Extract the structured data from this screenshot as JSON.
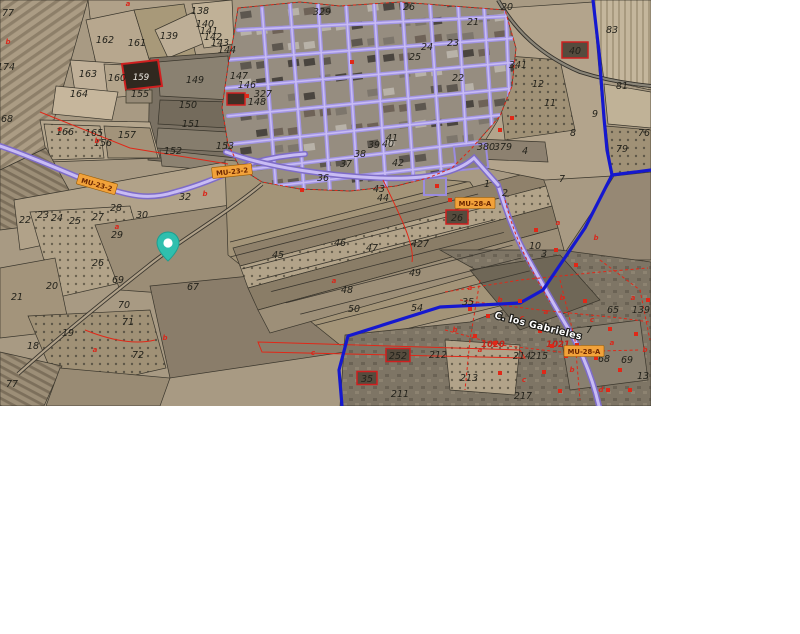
{
  "map": {
    "street_name": "C. los Gabrieles",
    "colors": {
      "pin": "#2fbfae",
      "boundary_line": "#1518cf",
      "road_purple": "#a295e4",
      "road_purple_core": "#c8bcf4",
      "road_label_bg": "#f2a23a",
      "road_label_text": "#6b2600",
      "red_overlay": "#e02818",
      "highlight_parcel_border": "#cf1f1f"
    },
    "pin": {
      "x": 168,
      "y": 247
    },
    "highlight_parcel": {
      "t": "159",
      "x": 141,
      "y": 80
    },
    "road_labels": [
      {
        "text": "MU-23-2",
        "x": 97,
        "y": 184,
        "rot": 16
      },
      {
        "text": "MU-23-2",
        "x": 232,
        "y": 171,
        "rot": -6
      },
      {
        "text": "MU-28-A",
        "x": 475,
        "y": 203,
        "rot": 0
      },
      {
        "text": "MU-28-A",
        "x": 584,
        "y": 351,
        "rot": 0
      }
    ],
    "red_boxed_parcels": [
      {
        "t": "40",
        "x": 575,
        "y": 53,
        "w": 26,
        "h": 16
      },
      {
        "t": "26",
        "x": 457,
        "y": 220,
        "w": 22,
        "h": 14
      },
      {
        "t": "35",
        "x": 367,
        "y": 381,
        "w": 20,
        "h": 13
      },
      {
        "t": "252",
        "x": 398,
        "y": 358,
        "w": 24,
        "h": 13
      }
    ],
    "red_text_labels": [
      {
        "t": "1020",
        "x": 493,
        "y": 347
      },
      {
        "t": "1021",
        "x": 558,
        "y": 347
      }
    ],
    "parcel_labels": [
      {
        "t": "77",
        "x": 8,
        "y": 16
      },
      {
        "t": "174",
        "x": 6,
        "y": 70
      },
      {
        "t": "68",
        "x": 7,
        "y": 122
      },
      {
        "t": "162",
        "x": 105,
        "y": 43
      },
      {
        "t": "161",
        "x": 137,
        "y": 46
      },
      {
        "t": "138",
        "x": 200,
        "y": 14
      },
      {
        "t": "139",
        "x": 169,
        "y": 39
      },
      {
        "t": "140",
        "x": 205,
        "y": 27
      },
      {
        "t": "141",
        "x": 209,
        "y": 34
      },
      {
        "t": "142",
        "x": 213,
        "y": 40
      },
      {
        "t": "143",
        "x": 220,
        "y": 46
      },
      {
        "t": "144",
        "x": 227,
        "y": 53
      },
      {
        "t": "163",
        "x": 88,
        "y": 77
      },
      {
        "t": "160",
        "x": 117,
        "y": 81
      },
      {
        "t": "149",
        "x": 195,
        "y": 83
      },
      {
        "t": "164",
        "x": 79,
        "y": 97
      },
      {
        "t": "150",
        "x": 188,
        "y": 108
      },
      {
        "t": "151",
        "x": 191,
        "y": 127
      },
      {
        "t": "155",
        "x": 140,
        "y": 97
      },
      {
        "t": "166",
        "x": 65,
        "y": 135
      },
      {
        "t": "165",
        "x": 94,
        "y": 136
      },
      {
        "t": "157",
        "x": 127,
        "y": 138
      },
      {
        "t": "156",
        "x": 103,
        "y": 146
      },
      {
        "t": "152",
        "x": 173,
        "y": 154
      },
      {
        "t": "153",
        "x": 225,
        "y": 149
      },
      {
        "t": "147",
        "x": 239,
        "y": 79
      },
      {
        "t": "146",
        "x": 247,
        "y": 88
      },
      {
        "t": "327",
        "x": 263,
        "y": 97
      },
      {
        "t": "148",
        "x": 257,
        "y": 105
      },
      {
        "t": "329",
        "x": 322,
        "y": 15
      },
      {
        "t": "26",
        "x": 409,
        "y": 10
      },
      {
        "t": "24",
        "x": 427,
        "y": 50
      },
      {
        "t": "25",
        "x": 415,
        "y": 60
      },
      {
        "t": "41",
        "x": 392,
        "y": 141
      },
      {
        "t": "39",
        "x": 374,
        "y": 148
      },
      {
        "t": "40",
        "x": 388,
        "y": 147
      },
      {
        "t": "38",
        "x": 360,
        "y": 157
      },
      {
        "t": "37",
        "x": 346,
        "y": 167
      },
      {
        "t": "42",
        "x": 398,
        "y": 166
      },
      {
        "t": "36",
        "x": 323,
        "y": 181
      },
      {
        "t": "43",
        "x": 379,
        "y": 192
      },
      {
        "t": "44",
        "x": 383,
        "y": 201
      },
      {
        "t": "45",
        "x": 278,
        "y": 258
      },
      {
        "t": "46",
        "x": 340,
        "y": 246
      },
      {
        "t": "47",
        "x": 372,
        "y": 251
      },
      {
        "t": "427",
        "x": 420,
        "y": 247
      },
      {
        "t": "49",
        "x": 415,
        "y": 276
      },
      {
        "t": "48",
        "x": 347,
        "y": 293
      },
      {
        "t": "50",
        "x": 354,
        "y": 312
      },
      {
        "t": "54",
        "x": 417,
        "y": 311
      },
      {
        "t": "379",
        "x": 503,
        "y": 150
      },
      {
        "t": "380",
        "x": 486,
        "y": 150
      },
      {
        "t": "4",
        "x": 525,
        "y": 154
      },
      {
        "t": "7",
        "x": 562,
        "y": 182
      },
      {
        "t": "1",
        "x": 487,
        "y": 187
      },
      {
        "t": "2",
        "x": 505,
        "y": 196
      },
      {
        "t": "20",
        "x": 507,
        "y": 10
      },
      {
        "t": "21",
        "x": 473,
        "y": 25
      },
      {
        "t": "23",
        "x": 453,
        "y": 46
      },
      {
        "t": "22",
        "x": 458,
        "y": 81
      },
      {
        "t": "341",
        "x": 518,
        "y": 68
      },
      {
        "t": "12",
        "x": 538,
        "y": 87
      },
      {
        "t": "11",
        "x": 550,
        "y": 106
      },
      {
        "t": "83",
        "x": 612,
        "y": 33
      },
      {
        "t": "81",
        "x": 622,
        "y": 89
      },
      {
        "t": "9",
        "x": 595,
        "y": 117
      },
      {
        "t": "8",
        "x": 573,
        "y": 136
      },
      {
        "t": "79",
        "x": 622,
        "y": 152
      },
      {
        "t": "76",
        "x": 644,
        "y": 136
      },
      {
        "t": "10",
        "x": 535,
        "y": 249
      },
      {
        "t": "3",
        "x": 544,
        "y": 257
      },
      {
        "t": "35",
        "x": 468,
        "y": 305
      },
      {
        "t": "212",
        "x": 438,
        "y": 358
      },
      {
        "t": "213",
        "x": 469,
        "y": 381
      },
      {
        "t": "211",
        "x": 400,
        "y": 397
      },
      {
        "t": "217",
        "x": 523,
        "y": 399
      },
      {
        "t": "214",
        "x": 522,
        "y": 359
      },
      {
        "t": "215",
        "x": 539,
        "y": 359
      },
      {
        "t": "7",
        "x": 589,
        "y": 333
      },
      {
        "t": "65",
        "x": 613,
        "y": 313
      },
      {
        "t": "139",
        "x": 641,
        "y": 313
      },
      {
        "t": "68",
        "x": 604,
        "y": 362
      },
      {
        "t": "69",
        "x": 627,
        "y": 363
      },
      {
        "t": "13",
        "x": 643,
        "y": 379
      },
      {
        "t": "22",
        "x": 25,
        "y": 223
      },
      {
        "t": "23",
        "x": 43,
        "y": 218
      },
      {
        "t": "24",
        "x": 57,
        "y": 221
      },
      {
        "t": "25",
        "x": 75,
        "y": 224
      },
      {
        "t": "27",
        "x": 98,
        "y": 220
      },
      {
        "t": "28",
        "x": 116,
        "y": 211
      },
      {
        "t": "30",
        "x": 142,
        "y": 218
      },
      {
        "t": "32",
        "x": 185,
        "y": 200
      },
      {
        "t": "29",
        "x": 117,
        "y": 238
      },
      {
        "t": "26",
        "x": 98,
        "y": 266
      },
      {
        "t": "69",
        "x": 118,
        "y": 283
      },
      {
        "t": "20",
        "x": 52,
        "y": 289
      },
      {
        "t": "21",
        "x": 17,
        "y": 300
      },
      {
        "t": "70",
        "x": 124,
        "y": 308
      },
      {
        "t": "71",
        "x": 128,
        "y": 325
      },
      {
        "t": "19",
        "x": 68,
        "y": 336
      },
      {
        "t": "18",
        "x": 33,
        "y": 349
      },
      {
        "t": "72",
        "x": 138,
        "y": 358
      },
      {
        "t": "67",
        "x": 193,
        "y": 290
      },
      {
        "t": "77",
        "x": 12,
        "y": 387
      }
    ],
    "marker_letters": [
      {
        "t": "a",
        "x": 128,
        "y": 6
      },
      {
        "t": "b",
        "x": 8,
        "y": 44
      },
      {
        "t": "a",
        "x": 60,
        "y": 131
      },
      {
        "t": "b",
        "x": 97,
        "y": 143
      },
      {
        "t": "a",
        "x": 117,
        "y": 229
      },
      {
        "t": "b",
        "x": 205,
        "y": 196
      },
      {
        "t": "a",
        "x": 334,
        "y": 283
      },
      {
        "t": "b",
        "x": 165,
        "y": 340
      },
      {
        "t": "a",
        "x": 95,
        "y": 352
      },
      {
        "t": "c",
        "x": 313,
        "y": 355
      },
      {
        "t": "a",
        "x": 470,
        "y": 290
      },
      {
        "t": "b",
        "x": 500,
        "y": 302
      },
      {
        "t": "c",
        "x": 522,
        "y": 320
      },
      {
        "t": "a",
        "x": 546,
        "y": 314
      },
      {
        "t": "b",
        "x": 562,
        "y": 300
      },
      {
        "t": "c",
        "x": 592,
        "y": 322
      },
      {
        "t": "a",
        "x": 612,
        "y": 345
      },
      {
        "t": "b",
        "x": 572,
        "y": 372
      },
      {
        "t": "c",
        "x": 524,
        "y": 382
      },
      {
        "t": "a",
        "x": 480,
        "y": 352
      },
      {
        "t": "b",
        "x": 455,
        "y": 332
      },
      {
        "t": "d",
        "x": 601,
        "y": 392
      },
      {
        "t": "a",
        "x": 633,
        "y": 300
      },
      {
        "t": "b",
        "x": 645,
        "y": 352
      },
      {
        "t": "a",
        "x": 558,
        "y": 225
      },
      {
        "t": "b",
        "x": 596,
        "y": 240
      }
    ],
    "red_house_marks": [
      {
        "x": 475,
        "y": 336
      },
      {
        "x": 495,
        "y": 343
      },
      {
        "x": 552,
        "y": 346
      },
      {
        "x": 566,
        "y": 356
      },
      {
        "x": 585,
        "y": 301
      },
      {
        "x": 540,
        "y": 331
      },
      {
        "x": 610,
        "y": 329
      },
      {
        "x": 520,
        "y": 301
      },
      {
        "x": 500,
        "y": 373
      },
      {
        "x": 560,
        "y": 391
      },
      {
        "x": 470,
        "y": 309
      },
      {
        "x": 488,
        "y": 316
      },
      {
        "x": 620,
        "y": 370
      },
      {
        "x": 636,
        "y": 334
      },
      {
        "x": 608,
        "y": 390
      },
      {
        "x": 648,
        "y": 300
      },
      {
        "x": 544,
        "y": 372
      },
      {
        "x": 577,
        "y": 345
      },
      {
        "x": 596,
        "y": 358
      },
      {
        "x": 630,
        "y": 390
      },
      {
        "x": 536,
        "y": 230
      },
      {
        "x": 556,
        "y": 250
      },
      {
        "x": 576,
        "y": 265
      },
      {
        "x": 500,
        "y": 130
      },
      {
        "x": 512,
        "y": 118
      },
      {
        "x": 437,
        "y": 186
      },
      {
        "x": 450,
        "y": 200
      },
      {
        "x": 247,
        "y": 96
      },
      {
        "x": 352,
        "y": 62
      },
      {
        "x": 302,
        "y": 190
      }
    ]
  }
}
